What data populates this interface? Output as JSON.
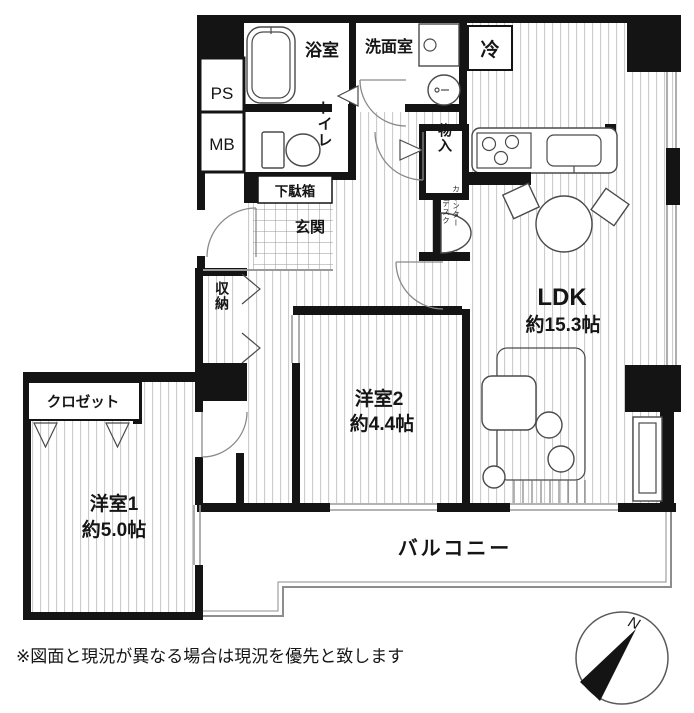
{
  "plan_labels": {
    "ps": "PS",
    "mb": "MB",
    "bath": "浴室",
    "washroom": "洗面室",
    "toilet": "トイレ",
    "storage_mono": "物入",
    "refrigerator": "冷",
    "shoe_box": "下駄箱",
    "entrance": "玄関",
    "storage": "収納",
    "counter_desk_1": "カウンター",
    "counter_desk_2": "デスク",
    "closet": "クロゼット",
    "balcony": "バルコニー"
  },
  "rooms": {
    "ldk": {
      "name": "LDK",
      "size": "約15.3帖"
    },
    "room2": {
      "name": "洋室2",
      "size": "約4.4帖"
    },
    "room1": {
      "name": "洋室1",
      "size": "約5.0帖"
    }
  },
  "compass": {
    "north": "N"
  },
  "note": "※図面と現況が異なる場合は現況を優先と致します",
  "colors": {
    "wall": "#141414",
    "floor_line": "#c6c6c6",
    "window": "#9a9a9a"
  }
}
